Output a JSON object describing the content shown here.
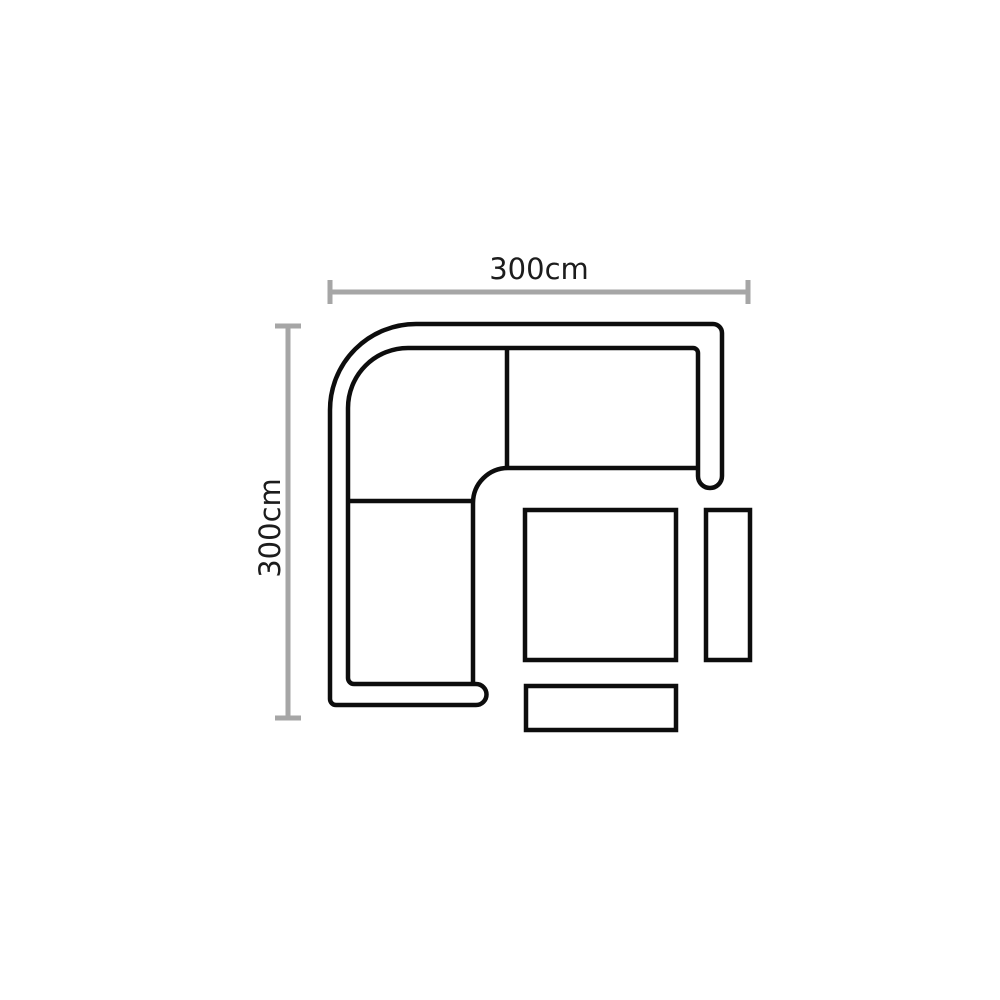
{
  "diagram": {
    "type": "furniture-floorplan-top-view",
    "subject": "corner-sofa-set-with-footstool-side-table-and-bench",
    "dimensions": {
      "width_label": "300cm",
      "depth_label": "300cm"
    },
    "colors": {
      "outline": "#0d0d0d",
      "dimension_line": "#a6a6a6",
      "label_text": "#1c1c1c",
      "background": "#ffffff"
    }
  }
}
